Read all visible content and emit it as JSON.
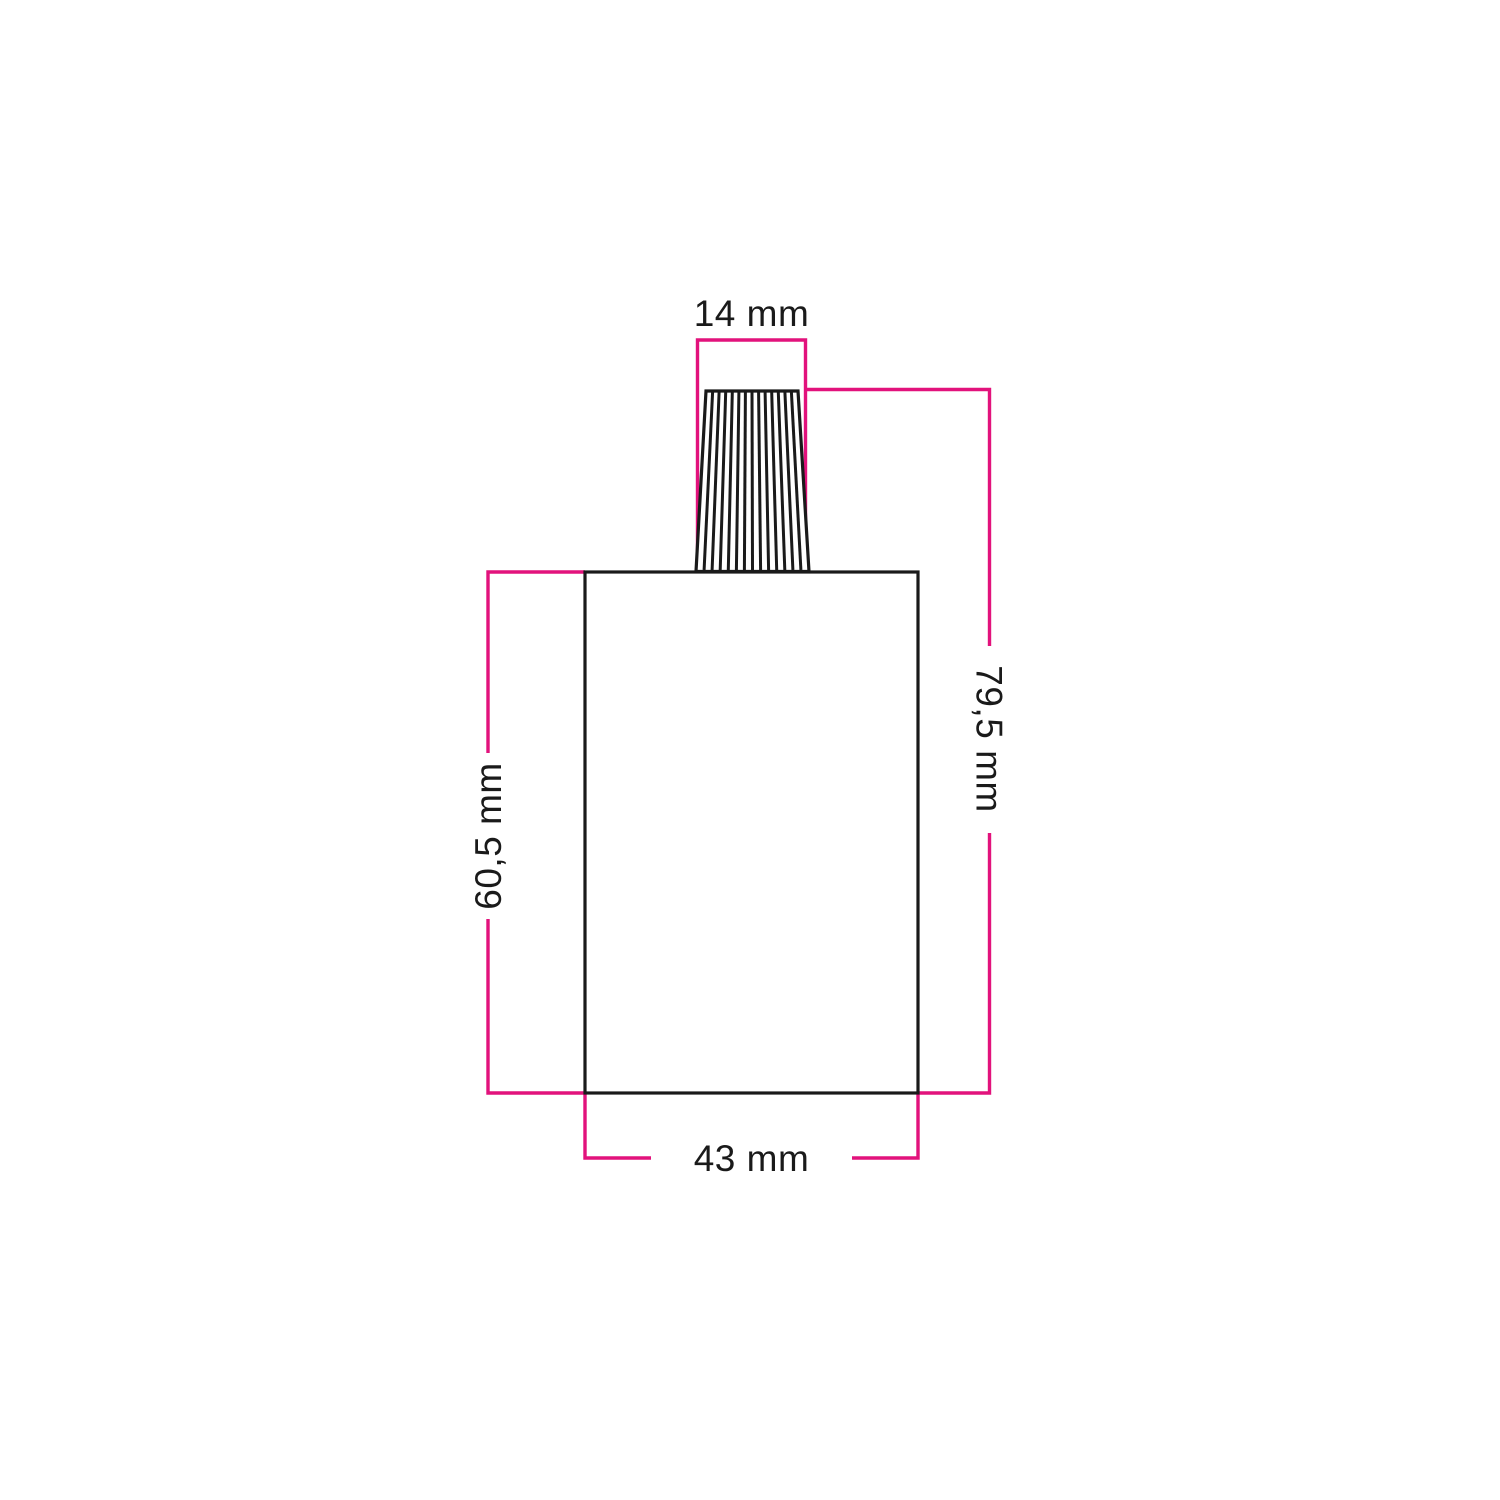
{
  "diagram": {
    "kind": "product-dimension-drawing",
    "subject": "cylindrical lamp holder with conical ribbed cable strain-relief on top"
  },
  "labels": {
    "cable_grip_width": "14 mm",
    "total_height": "79,5 mm",
    "body_height": "60,5 mm",
    "body_width": "43 mm"
  },
  "colors": {
    "background": "#ffffff",
    "dimension_line": "#e2127c",
    "outline": "#1a1a1a",
    "label_text": "#1a1a1a"
  }
}
